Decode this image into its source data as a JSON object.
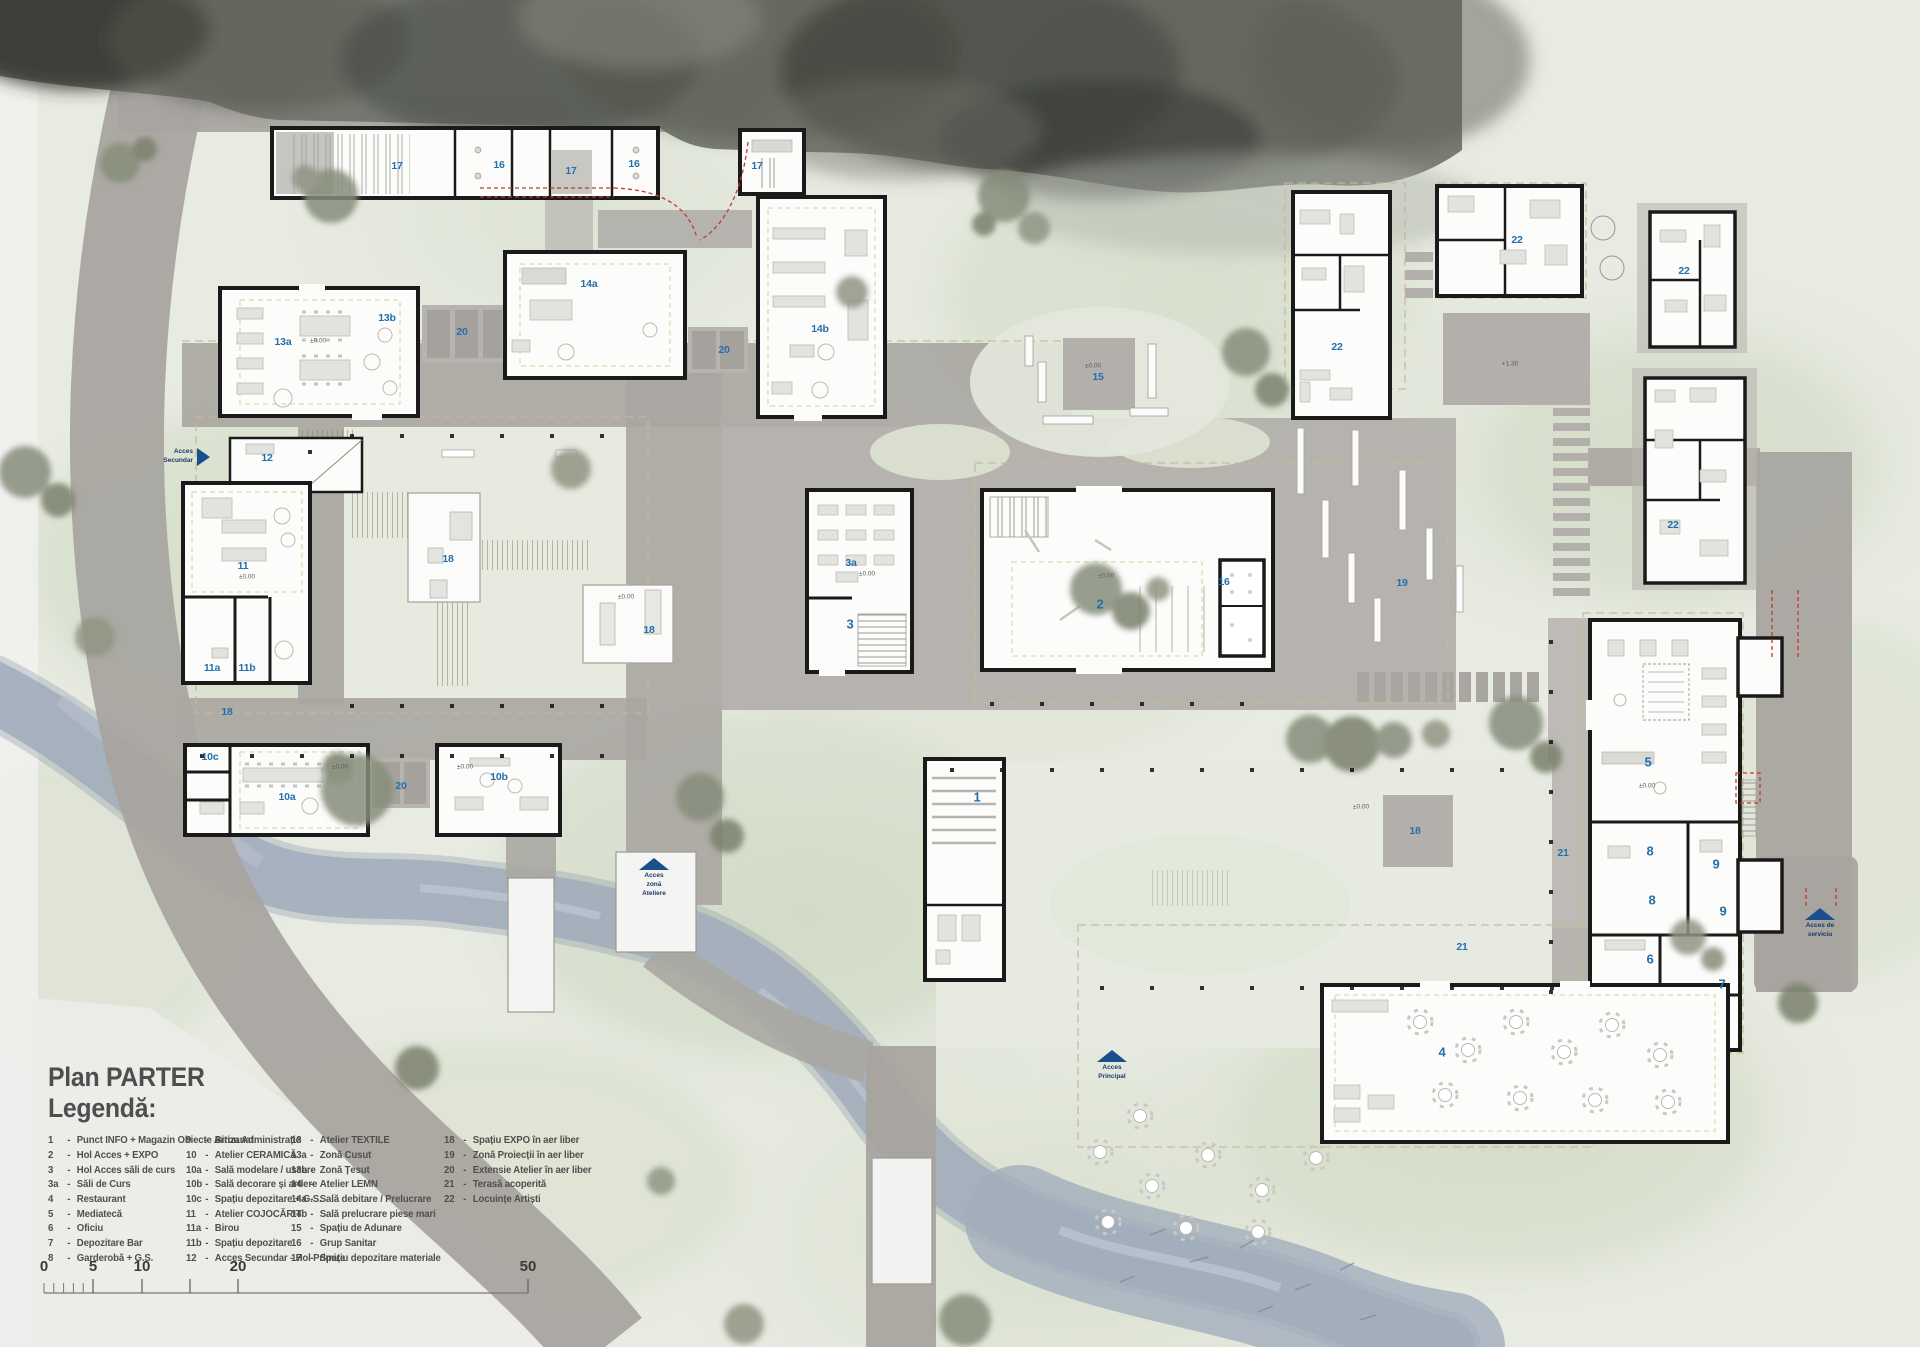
{
  "title": {
    "main": "Plan PARTER",
    "sub": "Legendă:"
  },
  "colors": {
    "room_label": "#2470ad",
    "arrow": "#1b4e8c"
  },
  "legend": {
    "sep": "-",
    "col1": [
      {
        "num": "1",
        "label": "Punct INFO + Magazin Obiecte Artizanat"
      },
      {
        "num": "2",
        "label": "Hol Acces + EXPO"
      },
      {
        "num": "3",
        "label": "Hol Acces săli de curs"
      },
      {
        "num": "3a",
        "label": "Săli de Curs"
      },
      {
        "num": "4",
        "label": "Restaurant"
      },
      {
        "num": "5",
        "label": "Mediatecă"
      },
      {
        "num": "6",
        "label": "Oficiu"
      },
      {
        "num": "7",
        "label": "Depozitare Bar"
      },
      {
        "num": "8",
        "label": "Garderobă + G.S."
      }
    ],
    "col2": [
      {
        "num": "9",
        "label": "Birou Administrație"
      },
      {
        "num": "10",
        "label": "Atelier CERAMICĂ"
      },
      {
        "num": "10a",
        "label": "Sală modelare / uscare"
      },
      {
        "num": "10b",
        "label": "Sală decorare și ardere"
      },
      {
        "num": "10c",
        "label": "Spațiu depozitare + G.S."
      },
      {
        "num": "11",
        "label": "Atelier COJOCĂRIT"
      },
      {
        "num": "11a",
        "label": "Birou"
      },
      {
        "num": "11b",
        "label": "Spațiu depozitare"
      },
      {
        "num": "12",
        "label": "Acces Secundar - Hol Primire"
      }
    ],
    "col3": [
      {
        "num": "13",
        "label": "Atelier TEXTILE"
      },
      {
        "num": "13a",
        "label": "Zonă Cusut"
      },
      {
        "num": "13b",
        "label": "Zonă Țesut"
      },
      {
        "num": "14",
        "label": "Atelier LEMN"
      },
      {
        "num": "14a",
        "label": "Sală debitare / Prelucrare"
      },
      {
        "num": "14b",
        "label": "Sală prelucrare piese mari"
      },
      {
        "num": "15",
        "label": "Spațiu de Adunare"
      },
      {
        "num": "16",
        "label": "Grup Sanitar"
      },
      {
        "num": "17",
        "label": "Spațiu depozitare materiale"
      }
    ],
    "col4": [
      {
        "num": "18",
        "label": "Spațiu EXPO în aer liber"
      },
      {
        "num": "19",
        "label": "Zonă Proiecții în aer liber"
      },
      {
        "num": "20",
        "label": "Extensie Atelier în aer liber"
      },
      {
        "num": "21",
        "label": "Terasă acoperită"
      },
      {
        "num": "22",
        "label": "Locuințe Artiști"
      }
    ]
  },
  "rooms": [
    {
      "t": "17",
      "x": 397,
      "y": 166
    },
    {
      "t": "16",
      "x": 499,
      "y": 165
    },
    {
      "t": "17",
      "x": 571,
      "y": 171
    },
    {
      "t": "16",
      "x": 634,
      "y": 164
    },
    {
      "t": "17",
      "x": 757,
      "y": 166
    },
    {
      "t": "13a",
      "x": 283,
      "y": 342
    },
    {
      "t": "13b",
      "x": 387,
      "y": 318
    },
    {
      "t": "20",
      "x": 462,
      "y": 332
    },
    {
      "t": "14a",
      "x": 589,
      "y": 284
    },
    {
      "t": "20",
      "x": 724,
      "y": 350
    },
    {
      "t": "14b",
      "x": 820,
      "y": 329
    },
    {
      "t": "12",
      "x": 267,
      "y": 458
    },
    {
      "t": "11",
      "x": 243,
      "y": 566
    },
    {
      "t": "11a",
      "x": 212,
      "y": 668
    },
    {
      "t": "11b",
      "x": 247,
      "y": 668
    },
    {
      "t": "18",
      "x": 227,
      "y": 712
    },
    {
      "t": "10c",
      "x": 210,
      "y": 757
    },
    {
      "t": "10a",
      "x": 287,
      "y": 797
    },
    {
      "t": "20",
      "x": 401,
      "y": 786
    },
    {
      "t": "10b",
      "x": 499,
      "y": 777
    },
    {
      "t": "18",
      "x": 448,
      "y": 559
    },
    {
      "t": "18",
      "x": 649,
      "y": 630
    },
    {
      "t": "15",
      "x": 1098,
      "y": 377
    },
    {
      "t": "3a",
      "x": 851,
      "y": 563
    },
    {
      "t": "3",
      "x": 850,
      "y": 624
    },
    {
      "t": "2",
      "x": 1100,
      "y": 604
    },
    {
      "t": "16",
      "x": 1224,
      "y": 582
    },
    {
      "t": "1",
      "x": 977,
      "y": 797
    },
    {
      "t": "19",
      "x": 1402,
      "y": 583
    },
    {
      "t": "18",
      "x": 1415,
      "y": 831
    },
    {
      "t": "21",
      "x": 1563,
      "y": 853
    },
    {
      "t": "21",
      "x": 1462,
      "y": 947
    },
    {
      "t": "22",
      "x": 1337,
      "y": 347
    },
    {
      "t": "22",
      "x": 1517,
      "y": 240
    },
    {
      "t": "22",
      "x": 1684,
      "y": 271
    },
    {
      "t": "22",
      "x": 1673,
      "y": 525
    },
    {
      "t": "5",
      "x": 1648,
      "y": 762
    },
    {
      "t": "8",
      "x": 1650,
      "y": 851
    },
    {
      "t": "9",
      "x": 1716,
      "y": 864
    },
    {
      "t": "8",
      "x": 1652,
      "y": 900
    },
    {
      "t": "9",
      "x": 1723,
      "y": 911
    },
    {
      "t": "6",
      "x": 1650,
      "y": 959
    },
    {
      "t": "7",
      "x": 1722,
      "y": 984
    },
    {
      "t": "4",
      "x": 1442,
      "y": 1052
    }
  ],
  "levels": [
    {
      "t": "±0.00",
      "x": 318,
      "y": 341
    },
    {
      "t": "±0.00",
      "x": 247,
      "y": 577
    },
    {
      "t": "±0.00",
      "x": 340,
      "y": 767
    },
    {
      "t": "±0.00",
      "x": 465,
      "y": 767
    },
    {
      "t": "±0.00",
      "x": 867,
      "y": 574
    },
    {
      "t": "±0.00",
      "x": 1106,
      "y": 576
    },
    {
      "t": "±0.00",
      "x": 626,
      "y": 597
    },
    {
      "t": "+1.30",
      "x": 1510,
      "y": 364
    },
    {
      "t": "±0.00",
      "x": 1647,
      "y": 786
    },
    {
      "t": "±0.00",
      "x": 1361,
      "y": 807
    },
    {
      "t": "±0.00",
      "x": 1093,
      "y": 366
    }
  ],
  "access": [
    {
      "lines": "Acces\nSecundar",
      "dir": "right",
      "x": 138,
      "y": 448
    },
    {
      "lines": "Acces\nzonă\nAteliere",
      "dir": "up",
      "x": 622,
      "y": 858
    },
    {
      "lines": "Acces\nPrincipal",
      "dir": "up",
      "x": 1080,
      "y": 1050
    },
    {
      "lines": "Acces de\nserviciu",
      "dir": "up",
      "x": 1788,
      "y": 908
    }
  ],
  "scalebar": {
    "labels": [
      "0",
      "5",
      "10",
      "20",
      "50"
    ],
    "x": [
      14,
      63,
      112,
      208,
      498
    ]
  }
}
